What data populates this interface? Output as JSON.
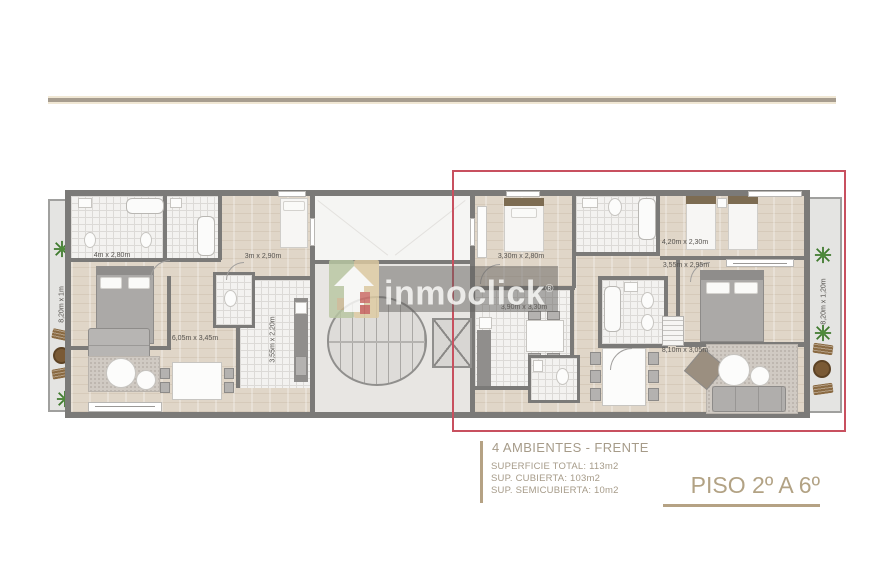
{
  "watermark": {
    "brand": "inmoclick",
    "registered": "®"
  },
  "floorplan": {
    "left_apartment": {
      "bedroom1_label": "4m x 2,80m",
      "bedroom2_label": "3m x 2,90m",
      "living_label": "6,05m x 3,45m",
      "kitchen_label": "3,55m x 2,20m",
      "balcony_label": "8,20m x 1m"
    },
    "right_apartment": {
      "bedroom1_label": "3,30m x 2,80m",
      "bedroom2_label": "4,20m x 2,30m",
      "bedroom3_label": "3,55m x 2,95m",
      "kitchen_label": "3,90m x 3,30m",
      "living_label": "8,10m x 3,05m",
      "balcony_label": "8,20m x 1,20m"
    }
  },
  "info_block": {
    "unit_title": "4 AMBIENTES - FRENTE",
    "superficie_total": "SUPERFICIE TOTAL: 113m2",
    "sup_cubierta": "SUP. CUBIERTA: 103m2",
    "sup_semicubierta": "SUP. SEMICUBIERTA: 10m2"
  },
  "floor_label": "PISO 2º A 6º",
  "colors": {
    "accent_tan": "#b5a284",
    "highlight_red": "#c8505f",
    "wall_gray": "#7b7a78",
    "plant_green": "#3f7a2e"
  }
}
